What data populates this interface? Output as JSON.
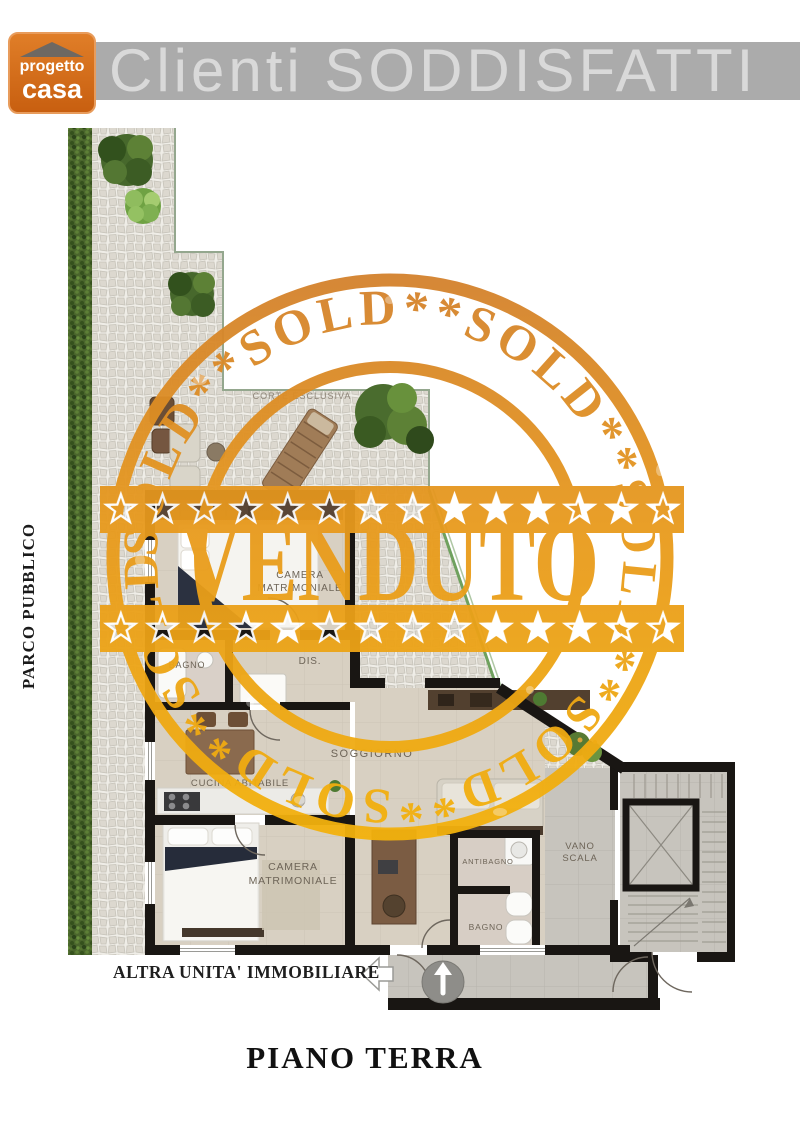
{
  "header": {
    "logo": {
      "word1": "progetto",
      "word2": "casa",
      "bg_color": "#d2691e"
    },
    "banner": {
      "text": "Clienti SODDISFATTI",
      "bg_color": "#ababab",
      "text_color": "#d9d9d9"
    }
  },
  "stamp": {
    "ring_text": "SOLD**SOLD**SOLD**SOLD**SOLD**SOLD**SOLD**",
    "center_text": "VENDUTO",
    "color_top": "#d2802e",
    "color_mid": "#e89a1d",
    "color_bottom": "#f4b30c"
  },
  "plan": {
    "park_label": "PARCO PUBBLICO",
    "terrace_label": "CORTE ESCLUSIVA",
    "labels": {
      "camera1_line1": "CAMERA",
      "camera1_line2": "MATRIMONIALE",
      "bagno1": "BAGNO",
      "dis": "DIS.",
      "cucina": "CUCINA ABITABILE",
      "camera2_line1": "CAMERA",
      "camera2_line2": "MATRIMONIALE",
      "soggiorno": "SOGGIORNO",
      "antibagno": "ANTIBAGNO",
      "bagno2": "BAGNO",
      "vano_line1": "VANO",
      "vano_line2": "SCALA"
    },
    "neighbor_label": "ALTRA UNITA' IMMOBILIARE",
    "floor_caption": "PIANO TERRA"
  },
  "icons": {
    "roof": "roof-triangle-icon",
    "entrance": "up-arrow-circle-icon",
    "neighbor": "left-arrow-icon"
  }
}
